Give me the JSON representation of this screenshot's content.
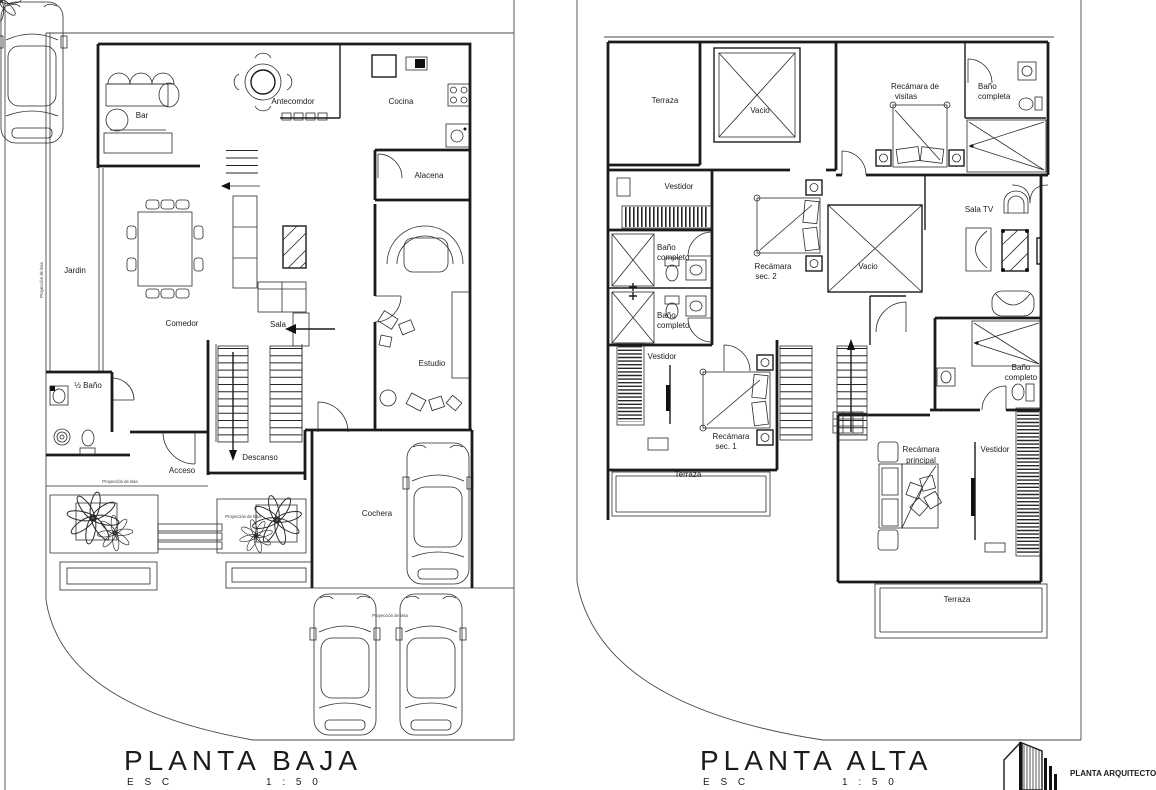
{
  "sheet": {
    "paper": "#ffffff",
    "ink": "#1b1b1b"
  },
  "baja": {
    "title": "PLANTA BAJA",
    "esc_label": "E S C",
    "esc_value": "1 : 5 0",
    "rooms": {
      "antecomedor": "Antecomdor",
      "cocina": "Cocina",
      "bar": "Bar",
      "alacena": "Alacena",
      "jardin": "Jardin",
      "comedor": "Comedor",
      "sala": "Sala",
      "estudio": "Estudio",
      "medio_bano": "½ Baño",
      "acceso": "Acceso",
      "descanso": "Descanso",
      "cochera": "Cochera"
    },
    "note_proyeccion": "Proyección de losa"
  },
  "alta": {
    "title": "PLANTA ALTA",
    "esc_label": "E S C",
    "esc_value": "1 : 5 0",
    "rooms": {
      "terraza_sup": "Terraza",
      "vacio_1": "Vacio",
      "rec_visitas_l1": "Recámara de",
      "rec_visitas_l2": "visitas",
      "bano_visitas_l1": "Baño",
      "bano_visitas_l2": "completa",
      "vestidor_sup": "Vestidor",
      "bano_1_l1": "Baño",
      "bano_1_l2": "completo",
      "bano_2_l1": "Baño",
      "bano_2_l2": "completo",
      "rec_sec2_l1": "Recámara",
      "rec_sec2_l2": "sec. 2",
      "vacio_2": "Vacio",
      "sala_tv": "Sala TV",
      "vestidor_med": "Vestidor",
      "rec_sec1_l1": "Recámara",
      "rec_sec1_l2": "sec. 1",
      "terraza_med": "Terraza",
      "bano_3_l1": "Baño",
      "bano_3_l2": "completo",
      "rec_ppal_l1": "Recámara",
      "rec_ppal_l2": "principal",
      "vestidor_ppal": "Vestidor",
      "terraza_inf": "Terraza"
    }
  },
  "footer": {
    "stamp": "PLANTA ARQUITECTO"
  }
}
